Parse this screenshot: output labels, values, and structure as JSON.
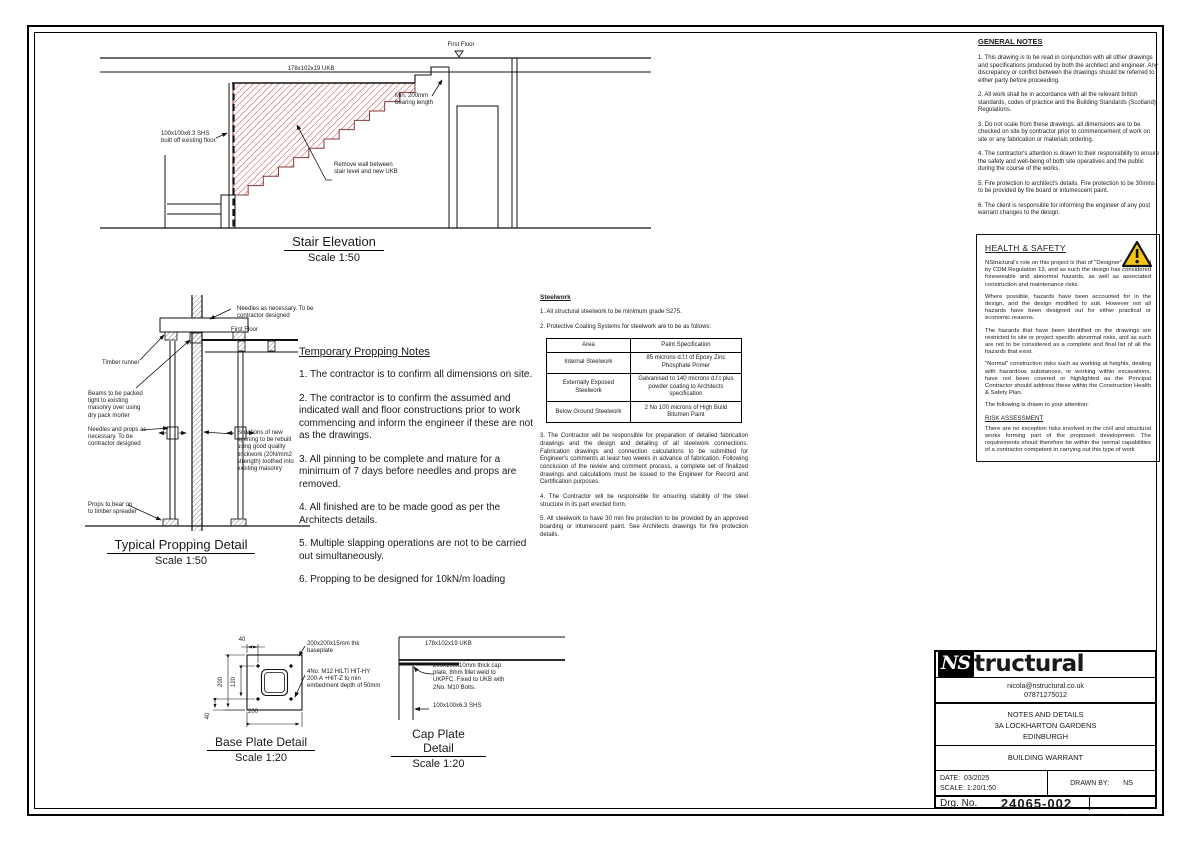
{
  "colors": {
    "hatch_red": "#c84545",
    "hatch_dark": "#555555",
    "line": "#111111",
    "warning_yellow": "#f4c514"
  },
  "stair_elevation": {
    "title": "Stair Elevation",
    "scale": "Scale 1:50",
    "labels": {
      "first_floor": "First Floor",
      "ukb": "178x102x19 UKB",
      "shs": "100x100x6.3 SHS built off existing floor",
      "bearing": "Min. 200mm bearing length",
      "remove_wall": "Remove wall between stair level and new UKB"
    }
  },
  "propping_detail": {
    "title": "Typical Propping Detail",
    "scale": "Scale 1:50",
    "labels": {
      "needles_top": "Needles as necessary. To be contractor designed",
      "first_floor": "First Floor",
      "timber_runner": "Timber runner",
      "beams_packed": "Beams to be packed tight to existing masonry over using dry pack morter",
      "needles_props": "Needles and props as necessary. To be contractor designed",
      "scuntions": "Scuntions of new opening to be rebuilt using good quality brickwork (20N/mm2 strength) toothed into existing masonry",
      "props_bear": "Props to bear on to timber spreader"
    }
  },
  "propping_notes": {
    "heading": "Temporary Propping Notes",
    "items": [
      "1. The contractor is to confirm all dimensions on site.",
      "2. The contractor is to confirm the assumed and indicated wall and floor constructions prior to work commencing and inform the engineer if these are not as the drawings.",
      "3. All pinning to be complete and mature for a minimum of 7 days before needles and props are removed.",
      "4. All finished are to be made good as per the Architects details.",
      "5. Multiple slapping operations are not to be carried out simultaneously.",
      "6. Propping to be designed for 10kN/m loading"
    ]
  },
  "steelwork": {
    "heading": "Steelwork",
    "note1": "1. All structural steelwork to be minimum grade S275.",
    "note2": "2. Protective Coating Systems for steelwork are to be as follows:",
    "table": {
      "headers": [
        "Area",
        "Paint Specification"
      ],
      "rows": [
        [
          "Internal Steelwork",
          "85 microns d.f.t of Epoxy Zinc Phosphate Primer"
        ],
        [
          "Externally Exposed Steelwork",
          "Galvanised to 140 microns d.f.t plus powder coating to Architects specification"
        ],
        [
          "Below Ground Steelwork",
          "2 No 100 microns of High Build Bitumen Paint"
        ]
      ]
    },
    "note3": "3. The Contractor will be responsible for preparation of detailed fabrication drawings and the design and detailing of all steelwork connections. Fabrication drawings and connection calculations to be submitted for Engineer's comments at least two weeks in advance of fabrication. Following conclusion of the review and comment process, a complete set of finalized drawings and calculations must be issued to the Engineer for Record and Certification purposes.",
    "note4": "4. The Contractor will be responsible for ensuring stability of the steel structure in its part erected form.",
    "note5": "5. All steelwork to have 30 min fire protection to be provided by an approved boarding or intumescent paint. See Architects drawings for fire protection details."
  },
  "base_plate": {
    "title": "Base Plate Detail",
    "scale": "Scale 1:20",
    "dims": {
      "top": "40",
      "left": "200",
      "inner": "120",
      "bottom_left": "40",
      "bottom": "200"
    },
    "labels": {
      "plate": "200x200x15mm thk baseplate",
      "bolts": "4No. M12 HILTI HIT-HY 200-A +HIT-Z to min embedment depth of 50mm"
    }
  },
  "cap_plate": {
    "title": "Cap Plate Detail",
    "scale": "Scale 1:20",
    "labels": {
      "ukb": "178x102x19 UKB",
      "plate": "200x100x10mm thick cap plate, 8mm fillet weld to UKPFC. Fixed to UKB with 2No. M10 Bolts.",
      "shs": "100x100x6.3 SHS"
    }
  },
  "general_notes": {
    "heading": "GENERAL NOTES",
    "items": [
      "1. This drawing is to be read in conjunction with all other drawings and specifications produced by both the architect and engineer. Any discrepancy or conflict between the drawings should be referred to either party before proceeding.",
      "2. All work shall be in accordance with all the relevant british standards, codes of practice and the Building Standards (Scotland) Regulations.",
      "3. Do not scale from these drawings. all dimensions are to be checked on site by contractor prior to commencement of work on site or any fabrication or materials ordering.",
      "4. The contractor's attention is drawn to their responsibility to ensure the safety and well-being of both site operatives and the public during the course of the works.",
      "5. Fire protection to architect's details. Fire protection to be 30mins to be provided by fire board or intumescent paint.",
      "6. The client is responsible for informing the engineer of any post warrant changes to the design."
    ]
  },
  "health_safety": {
    "heading": "HEALTH & SAFETY",
    "p1": "NStructural's  role on this project is that of \"Designer\" as defined by CDM Regulation 13, and as such the design has considered foreseeable and abnormal hazards, as well as associated construction and maintenance risks.",
    "p2": "Where possible, hazards have been accounted for in the design, and the design modified to suit. However not all hazards have been designed out for either practical or economic reasons.",
    "p3": "The hazards that have been identified on the drawings are restricted to site or project specific abnormal risks, and as such are not to be considered as a complete and final list of all the hazards that exist.",
    "p4": "\"Normal\" construction risks such as working at heights, dealing with hazardous substances, or working within excavations, have not been covered or highlighted as the Principal Contractor should address these within the Construction Health & Safety Plan.",
    "attention": "The following is drawn to your attention:",
    "risk_heading": "RISK ASSESSMENT",
    "risk_text": "There are no exception risks involved in the civil and structural works forming part of the proposed development. The requirements shoud therefore be within the normal capabilities of a contractor competent in carrying out this type of work"
  },
  "title_block": {
    "logo_ns": "NS",
    "logo_rest": "tructural",
    "email": "nicola@nstructural.co.uk",
    "phone": "07871275012",
    "project_line1": "NOTES AND DETAILS",
    "project_line2": "3A LOCKHARTON GARDENS",
    "project_line3": "EDINBURGH",
    "stage": "BUILDING WARRANT",
    "date_label": "DATE:",
    "date_value": "03/2025",
    "scale_label": "SCALE:",
    "scale_value": "1:20/1:50",
    "drawn_label": "DRAWN BY:",
    "drawn_value": "NS",
    "drg_label": "Drg. No.",
    "drg_value": "24065-002",
    "rev_value": "_"
  }
}
